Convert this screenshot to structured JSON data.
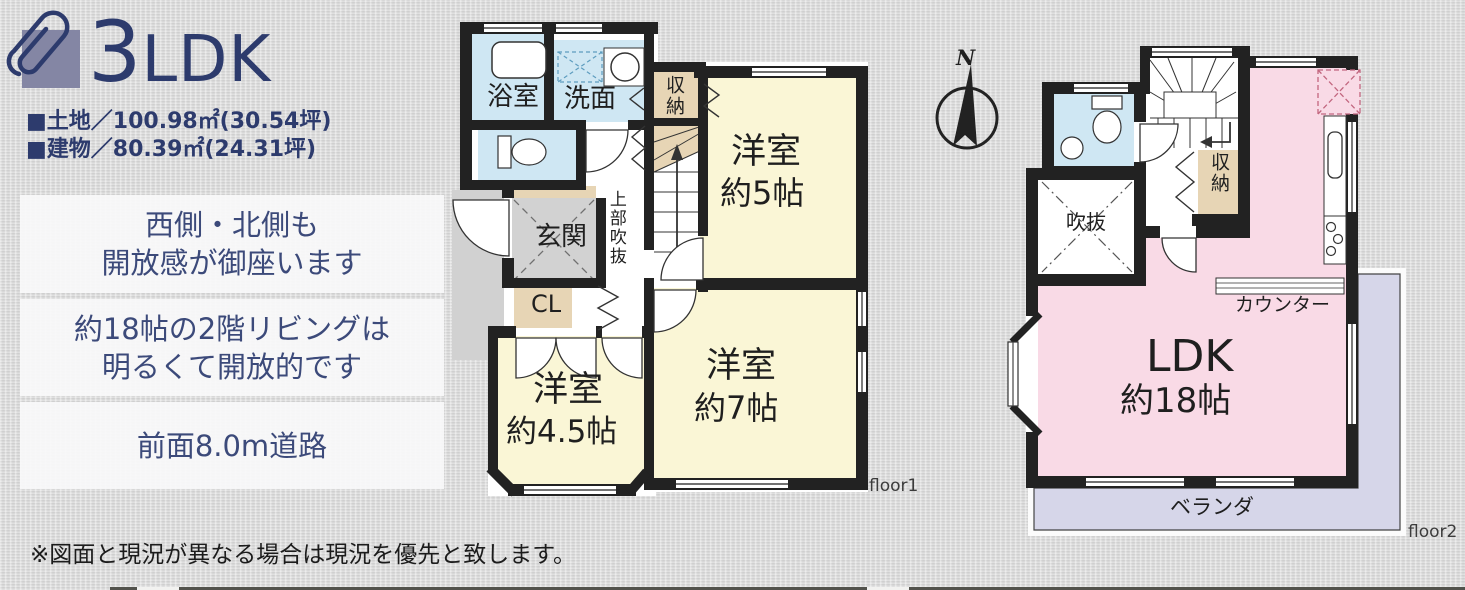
{
  "header": {
    "unit_type_number": "3",
    "unit_type_suffix": "LDK",
    "land_area": "■土地／100.98㎡(30.54坪)",
    "building_area": "■建物／80.39㎡(24.31坪)"
  },
  "highlights": [
    {
      "line1": "西側・北側も",
      "line2": "開放感が御座います"
    },
    {
      "line1": "約18帖の2階リビングは",
      "line2": "明るくて開放的です"
    },
    {
      "line1": "前面8.0m道路"
    }
  ],
  "disclaimer": "※図面と現況が異なる場合は現況を優先と致します。",
  "compass": {
    "north": "N"
  },
  "floor1": {
    "label": "floor1",
    "bath": "浴室",
    "washroom": "洗面",
    "storage": "収納",
    "room5_name": "洋室",
    "room5_size": "約5帖",
    "entrance": "玄関",
    "upper_void": "上部吹抜",
    "closet": "CL",
    "room45_name": "洋室",
    "room45_size": "約4.5帖",
    "room7_name": "洋室",
    "room7_size": "約7帖"
  },
  "floor2": {
    "label": "floor2",
    "storage": "収納",
    "void": "吹抜",
    "counter": "カウンター",
    "ldk_name": "LDK",
    "ldk_size": "約18帖",
    "veranda": "ベランダ"
  },
  "colors": {
    "navy": "#2d3b6d",
    "wall": "#222222",
    "room_yellow": "#faf6d6",
    "water_blue": "#cfe7f3",
    "closet_beige": "#e7d5b5",
    "entrance_gray": "#d2d2d2",
    "ldk_pink": "#f9dae6",
    "balcony_lavender": "#d6d6e9"
  }
}
